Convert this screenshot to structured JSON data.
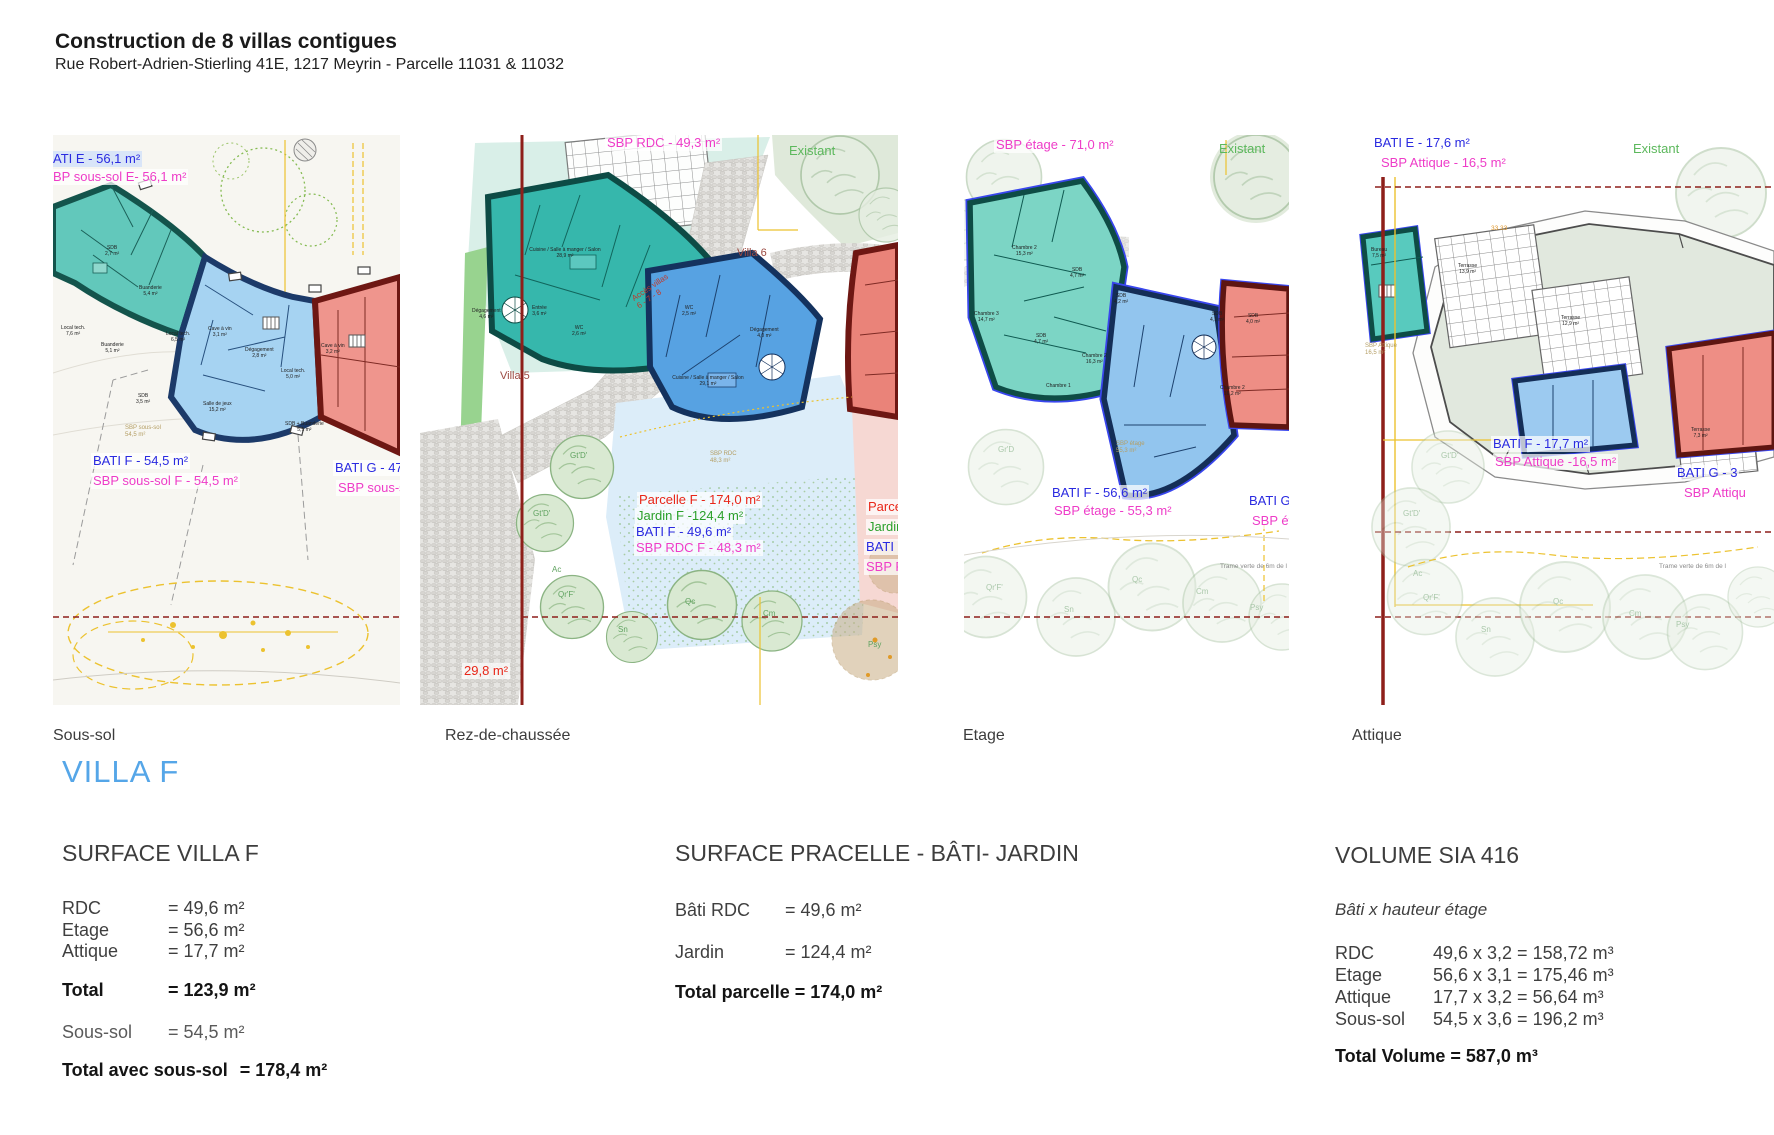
{
  "header": {
    "title": "Construction de 8 villas contigues",
    "subtitle": "Rue Robert-Adrien-Stierling 41E, 1217 Meyrin - Parcelle 11031 & 11032"
  },
  "captions": {
    "sous_sol": "Sous-sol",
    "rdc": "Rez-de-chaussée",
    "etage": "Etage",
    "attique": "Attique"
  },
  "villa_title": "VILLA F",
  "colors": {
    "accent_blue": "#55a6e8",
    "label_blue": "#2a2ae0",
    "label_magenta": "#ee3cc8",
    "label_red": "#e82618",
    "label_green": "#2ba02b",
    "teal_fill": "#36b7ac",
    "blue_fill": "#57a2e2",
    "red_fill": "#ea8379"
  },
  "panels": {
    "sous_sol": {
      "bati_e": "ATI E - 56,1 m²",
      "sbp_e": "BP sous-sol  E- 56,1 m²",
      "bati_f": "BATI F - 54,5 m²",
      "sbp_f": "SBP sous-sol F - 54,5 m²",
      "bati_g": "BATI G - 47,5",
      "sbp_g": "SBP sous-sol",
      "sbp_inner": "SBP sous-sol\n54,5 m²",
      "rooms": {
        "sdb_e": "SDB\n2,7 m²",
        "buanderie_e": "Buanderie\n5,4 m²",
        "local_e": "Local tech.\n7,6 m²",
        "buanderie_f": "Buanderie\n5,1 m²",
        "local_f": "Local tech.\n6,5 m²",
        "cave_f": "Cave à vin\n3,1 m²",
        "degagement_f": "Dégagement\n2,8 m²",
        "sdb_f": "SDB\n3,5 m²",
        "salle_jeux": "Salle de jeux\n15,2 m²",
        "local_g": "Local tech.\n5,0 m²",
        "cave_g": "Cave à vin\n3,2 m²",
        "sdb_g": "SDB + Buanderie\n5,1 m²"
      }
    },
    "rdc": {
      "sbp": "SBP RDC - 49,3 m²",
      "existant": "Existant",
      "villa5": "Villa 5",
      "villa6": "Villa 6",
      "acces": "Accès villas\n6 - 7 - 8",
      "parcelle_f": "Parcelle F - 174,0 m²",
      "jardin_f": "Jardin F -124,4 m²",
      "bati_f": "BATI F -  49,6 m²",
      "sbp_f": "SBP RDC F - 48,3 m²",
      "area": "29,8 m²",
      "parcelle_g": "Parcelle",
      "jardin_g": "Jardin G",
      "bati_g": "BATI G",
      "sbp_g": "SBP RD",
      "sbp_inner": "SBP RDC\n48,3 m²",
      "trees": [
        "Gt'D'",
        "Gt'D'",
        "Ac",
        "Qr'F'",
        "Sn",
        "Qc",
        "Cm",
        "Psy"
      ],
      "rooms": {
        "cuisine_e": "Cuisine / Salle à manger / Salon\n28,9 m²",
        "degagement_e": "Dégagement\n4,6 m²",
        "entree_e": "Entrée\n3,6 m²",
        "wc_e": "WC\n2,6 m²",
        "wc_f": "WC\n2,5 m²",
        "degagement_f": "Dégagement\n4,0 m²",
        "cuisine_f": "Cuisine / Salle à manger / Salon\n29,1 m²"
      }
    },
    "etage": {
      "sbp": "SBP étage - 71,0 m²",
      "existant": "Existant",
      "bati_f": "BATI F - 56,6 m²",
      "sbp_f": "SBP étage - 55,3 m²",
      "bati_g": "BATI G -",
      "sbp_g": "SBP étag",
      "sbp_inner": "SBP étage\n55,3 m²",
      "trame": "Trame verte de 6m de l",
      "trees": [
        "Gr'D",
        "Qr'F'",
        "Sn",
        "Qc",
        "Cm",
        "Psy"
      ],
      "rooms": {
        "chambre2_e": "Chambre 2\n15,3 m²",
        "sdb_e": "SDB\n4,7 m²",
        "chambre3_e": "Chambre 3\n14,7 m²",
        "sdb_e2": "SDB\n4,7 m²",
        "sdb_f": "SDB\n4,2 m²",
        "chambre1_f": "Chambre 1",
        "chambre2_f": "Chambre 2\n16,3 m²",
        "sdb_g": "SDB\n4,1 m²",
        "sdb_g2": "SDB\n4,0 m²",
        "chambre2_g": "Chambre 2\n16,2 m²"
      }
    },
    "attique": {
      "bati_e": "BATI E - 17,6 m²",
      "sbp_e": "SBP Attique - 16,5 m²",
      "existant": "Existant",
      "bati_f": "BATI F - 17,7 m²",
      "sbp_f": "SBP Attique -16,5 m²",
      "bati_g": "BATI G - 3",
      "sbp_g": "SBP Attiqu",
      "sbp_inner": "SBP Attique\n16,5 m²",
      "mark": "33.33",
      "trame": "Trame verte de 6m de l",
      "trees": [
        "Gt'D'",
        "Gt'D'",
        "Ac",
        "Qr'F'",
        "Sn",
        "Qc",
        "Cm",
        "Psy"
      ],
      "rooms": {
        "bureau": "Bureau\n7,5 m²",
        "terrasse1": "Terrasse\n13,9 m²",
        "terrasse2": "Terrasse\n12,9 m²",
        "terrasse3": "Terrasse\n7,3 m²"
      }
    }
  },
  "surface_villa": {
    "heading": "SURFACE VILLA F",
    "rows": [
      [
        "RDC",
        "= 49,6 m²"
      ],
      [
        "Etage",
        "= 56,6 m²"
      ],
      [
        "Attique",
        "= 17,7 m²"
      ]
    ],
    "total_label": "Total",
    "total_value": "= 123,9 m²",
    "soussol_label": "Sous-sol",
    "soussol_value": "= 54,5 m²",
    "grand_label": "Total avec sous-sol",
    "grand_value": "= 178,4 m²"
  },
  "surface_parcelle": {
    "heading": "SURFACE PRACELLE - BÂTI- JARDIN",
    "rows": [
      [
        "Bâti RDC",
        "= 49,6 m²"
      ],
      [
        "Jardin",
        "= 124,4  m²"
      ]
    ],
    "total": "Total parcelle = 174,0 m²"
  },
  "volume": {
    "heading": "VOLUME SIA 416",
    "note": "Bâti x hauteur étage",
    "rows": [
      [
        "RDC",
        "49,6 x 3,2 = 158,72 m³"
      ],
      [
        "Etage",
        "56,6 x 3,1 = 175,46 m³"
      ],
      [
        "Attique",
        "17,7 x 3,2 = 56,64 m³"
      ],
      [
        "Sous-sol",
        "54,5 x 3,6 = 196,2 m³"
      ]
    ],
    "total": "Total Volume = 587,0 m³"
  }
}
